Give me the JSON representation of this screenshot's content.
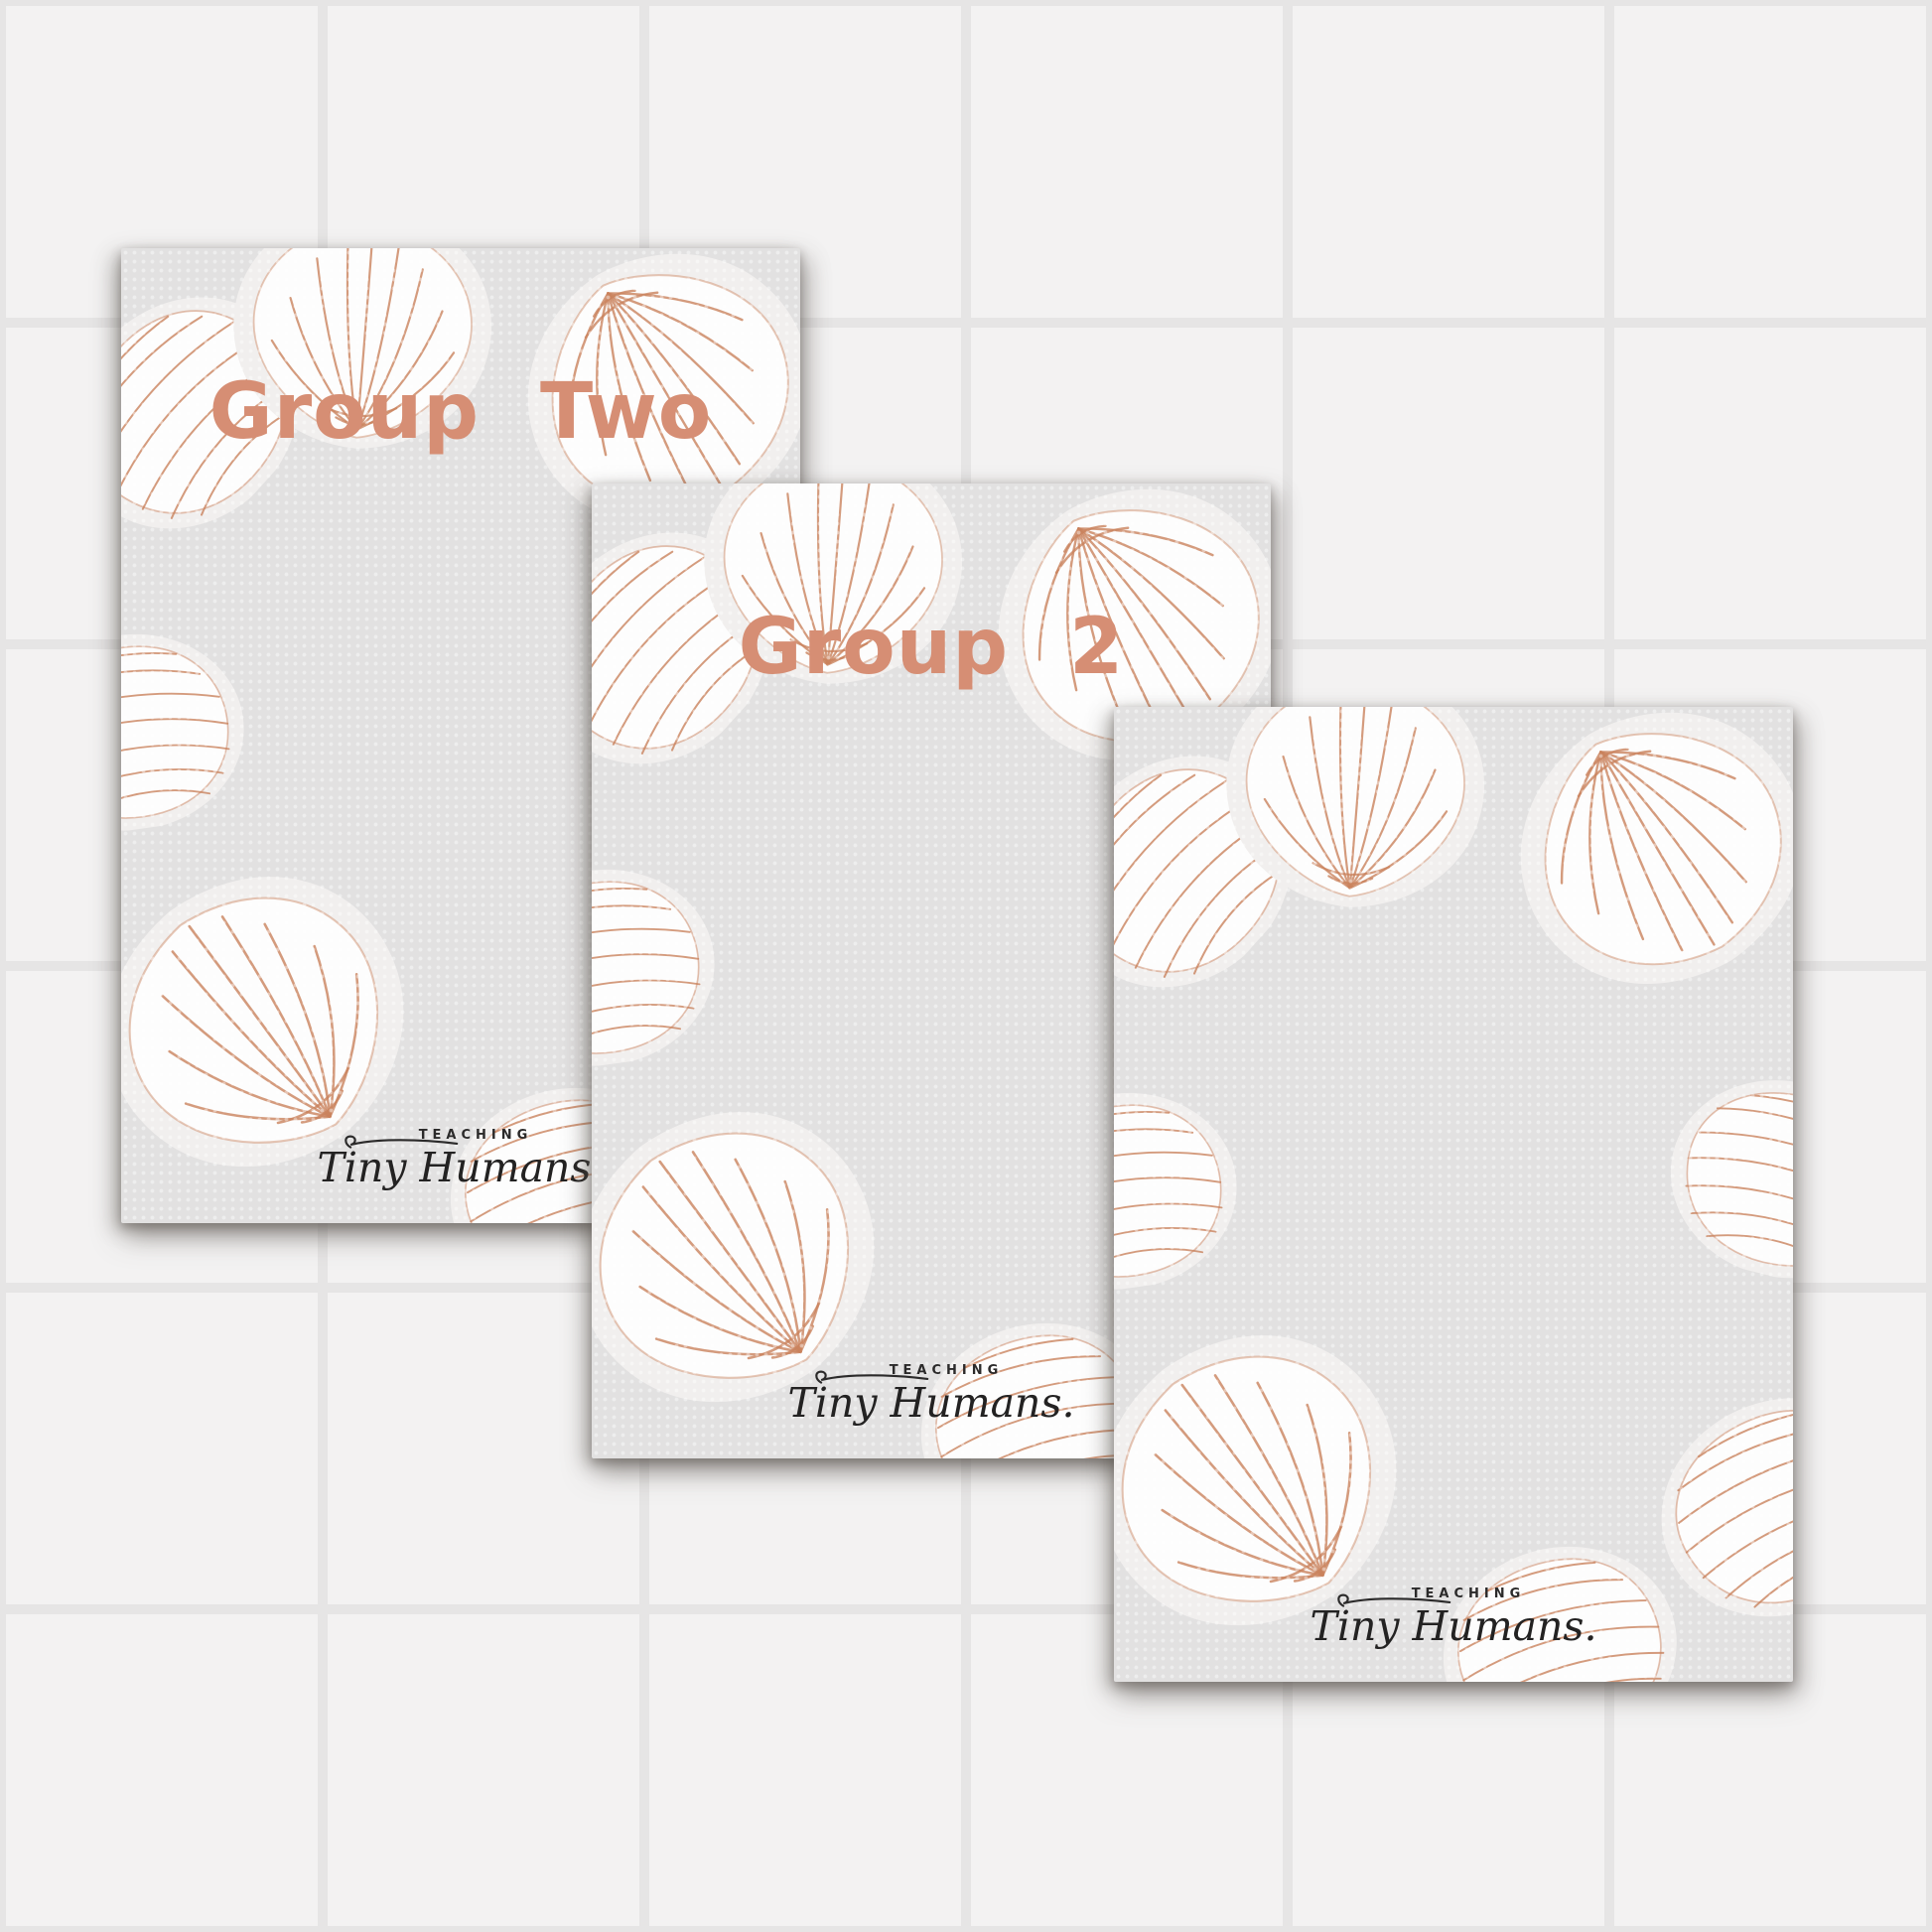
{
  "background": {
    "tile_color": "#f3f2f2",
    "grid_line_color": "#e6e5e5"
  },
  "colors": {
    "card_background": "#e2e1e1",
    "title_text": "#d68e74",
    "shell_outline": "#c9825d",
    "shell_fill": "#fdfdfd",
    "logo_text": "#2b2a2a"
  },
  "cards": [
    {
      "title": "Group Two"
    },
    {
      "title": "Group 2"
    },
    {
      "title": ""
    }
  ],
  "logo": {
    "top_text": "TEACHING",
    "script_text": "Tiny Humans."
  },
  "icons": {
    "shells": [
      "scallop-shell-icon",
      "clam-shell-icon"
    ],
    "flourish": "signature-flourish-stroke"
  }
}
